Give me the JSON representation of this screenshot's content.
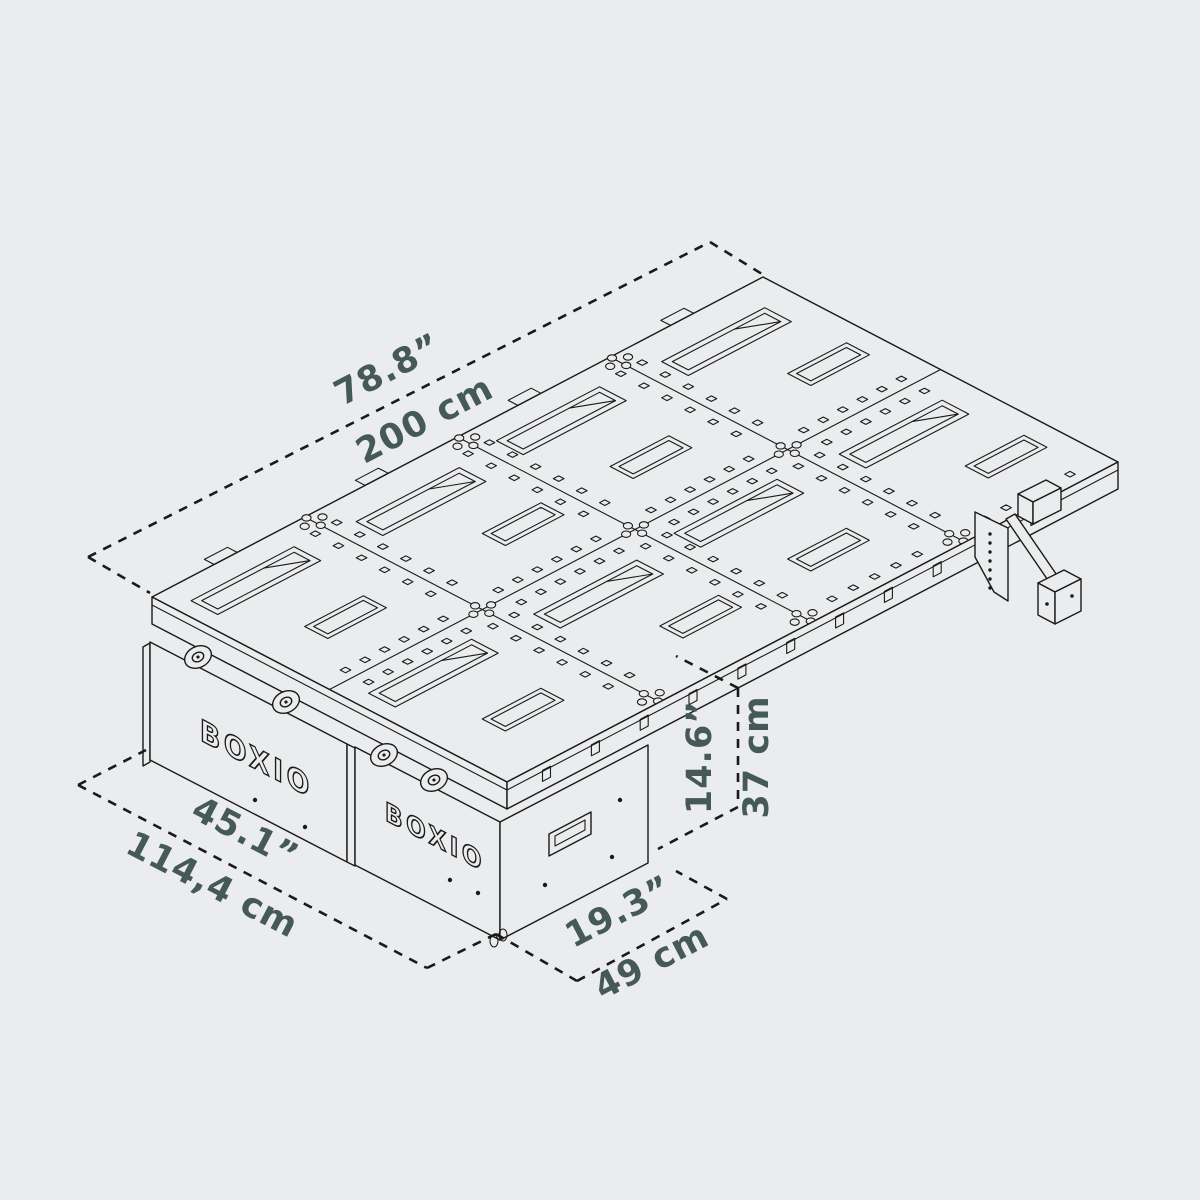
{
  "diagram": {
    "brand_logo": "BOXIO",
    "colors": {
      "background": "#ebeced",
      "line": "#1a1a1a",
      "dimension_text": "#465a55"
    },
    "dimensions": {
      "length": {
        "imperial": "78.8”",
        "metric": "200 cm"
      },
      "width": {
        "imperial": "45.1”",
        "metric": "114,4 cm"
      },
      "depth": {
        "imperial": "19.3”",
        "metric": "49 cm"
      },
      "height": {
        "imperial": "14.6”",
        "metric": "37 cm"
      }
    }
  }
}
